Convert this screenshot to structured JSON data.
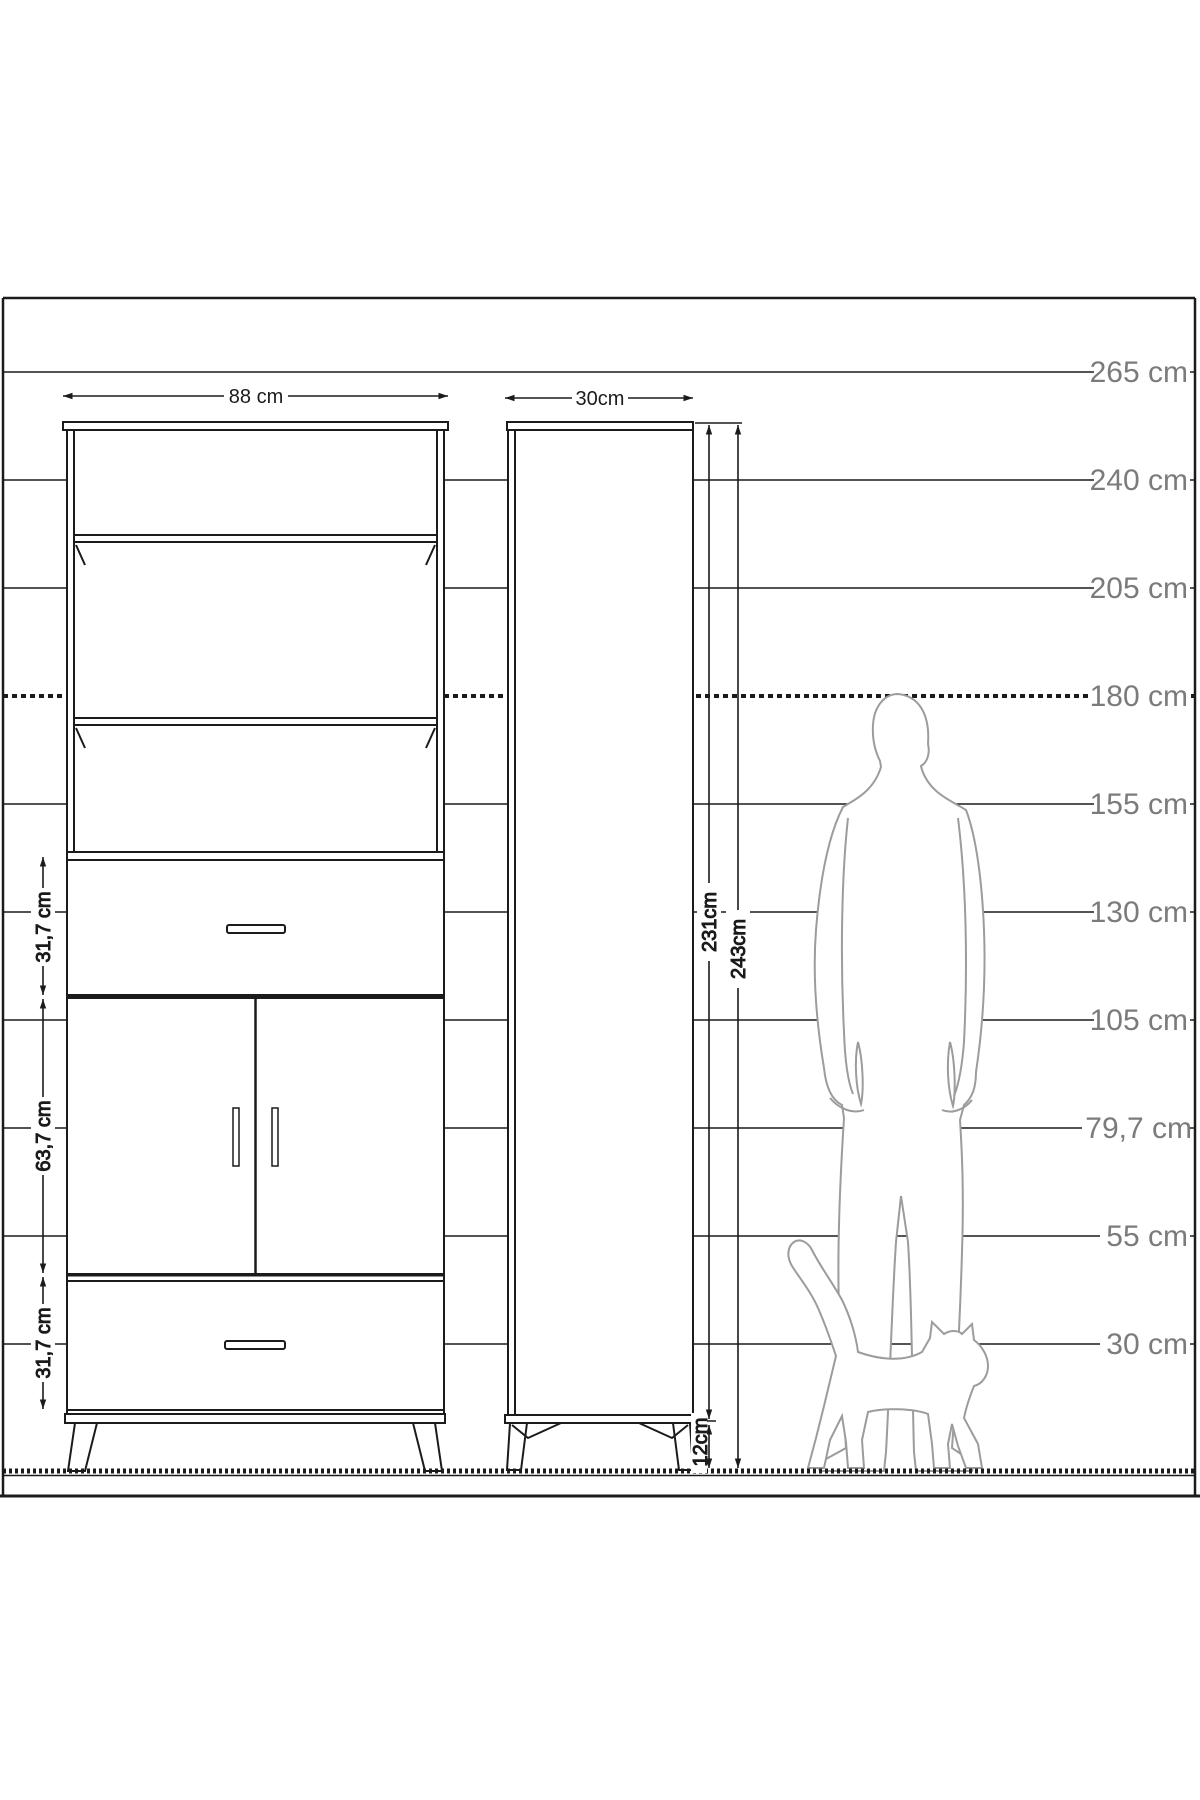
{
  "drawing": {
    "title_hint": "furniture dimension diagram with human and cat scale silhouettes",
    "scale_labels": [
      "265 cm",
      "240 cm",
      "205 cm",
      "180 cm",
      "155 cm",
      "130 cm",
      "105 cm",
      "79,7 cm",
      "55 cm",
      "30 cm"
    ],
    "dimensions": {
      "front_width": "88 cm",
      "side_depth": "30cm",
      "top_drawer_height": "31,7 cm",
      "door_section_height": "63,7 cm",
      "bottom_drawer_height": "31,7 cm",
      "body_height": "231cm",
      "total_height": "243cm",
      "leg_height": "12cm"
    },
    "colors": {
      "line": "#1b1b1b",
      "silhouette": "#9c9c9c",
      "scale_text": "#7b7b7b",
      "background": "#ffffff"
    }
  }
}
